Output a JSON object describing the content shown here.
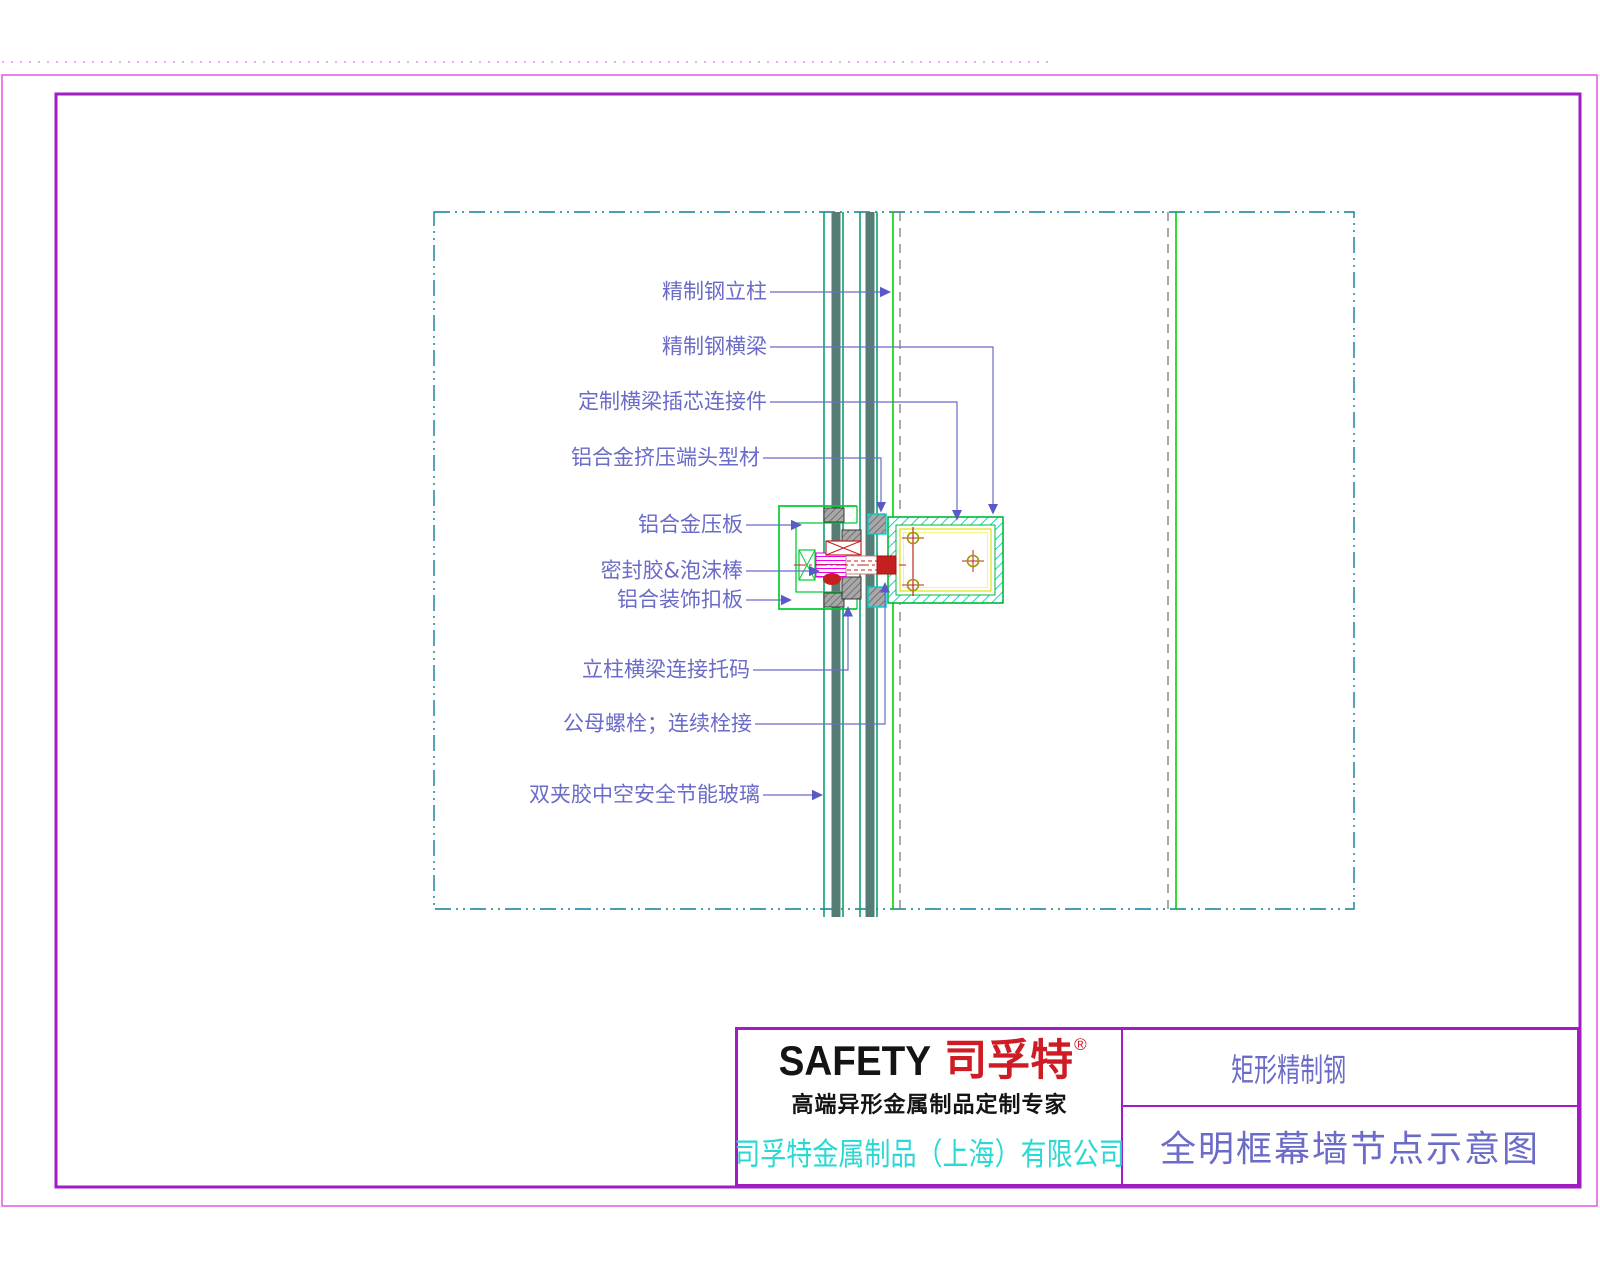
{
  "drawing": {
    "labels": [
      {
        "text": "精制钢立柱"
      },
      {
        "text": "精制钢横梁"
      },
      {
        "text": "定制横梁插芯连接件"
      },
      {
        "text": "铝合金挤压端头型材"
      },
      {
        "text": "铝合金压板"
      },
      {
        "text": "密封胶&泡沫棒"
      },
      {
        "text": "铝合装饰扣板"
      },
      {
        "text": "立柱横梁连接托码"
      },
      {
        "text": "公母螺栓；连续栓接"
      },
      {
        "text": "双夹胶中空安全节能玻璃"
      }
    ]
  },
  "title_block": {
    "logo": {
      "latin": "SAFETY",
      "cjk": "司孚特",
      "reg_mark": "®",
      "tagline": "高端异形金属制品定制专家"
    },
    "company": "司孚特金属制品（上海）有限公司",
    "series_title": "矩形精制钢",
    "drawing_title": "全明框幕墙节点示意图"
  },
  "colors": {
    "inner_border_purple": "#a21cc4",
    "outer_border_magenta": "#e455e4",
    "annotation_blue": "#6b6bc8",
    "detail_border_teal": "#0e7e99",
    "glass_edge_green": "#0aa070",
    "glass_core_teal": "#557d75",
    "mullion_line_green": "#00d400",
    "grid_dashed_gray": "#7d7d7d",
    "steel_outline_green": "#00bb33",
    "hatch_cyan": "#00c8c8",
    "inner_liner_yellow": "#e3e330",
    "bolt_magenta": "#dd00dd",
    "bolt_red": "#c51f1f",
    "brand_red": "#cf1b24",
    "company_cyan": "#2cd8d2"
  }
}
